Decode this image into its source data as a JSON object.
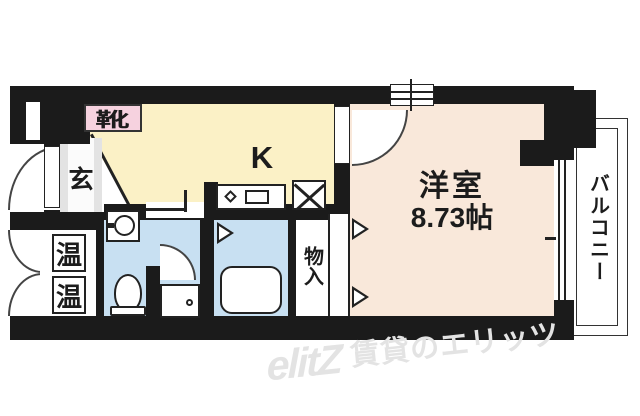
{
  "floorplan": {
    "rooms": {
      "entrance": {
        "label": "玄"
      },
      "shoe_cabinet": {
        "label": "靴"
      },
      "kitchen": {
        "label": "K"
      },
      "western_room": {
        "label": "洋室",
        "size": "8.73帖"
      },
      "balcony": {
        "label": "バルコニー"
      },
      "storage": {
        "label": "物入"
      },
      "water_heater_top": {
        "label": "温"
      },
      "water_heater_bottom": {
        "label": "温"
      }
    },
    "colors": {
      "wall": "#1b1b1b",
      "kitchen": "#fbf1c6",
      "western_room": "#f9e8da",
      "wet_area": "#c8e0f2",
      "entrance": "#e3e3e3",
      "pink": "#f6d2df",
      "watermark": "#e3e3e3"
    }
  },
  "watermark": {
    "logo": "elitZ",
    "text": "賃貸のエリッツ"
  }
}
